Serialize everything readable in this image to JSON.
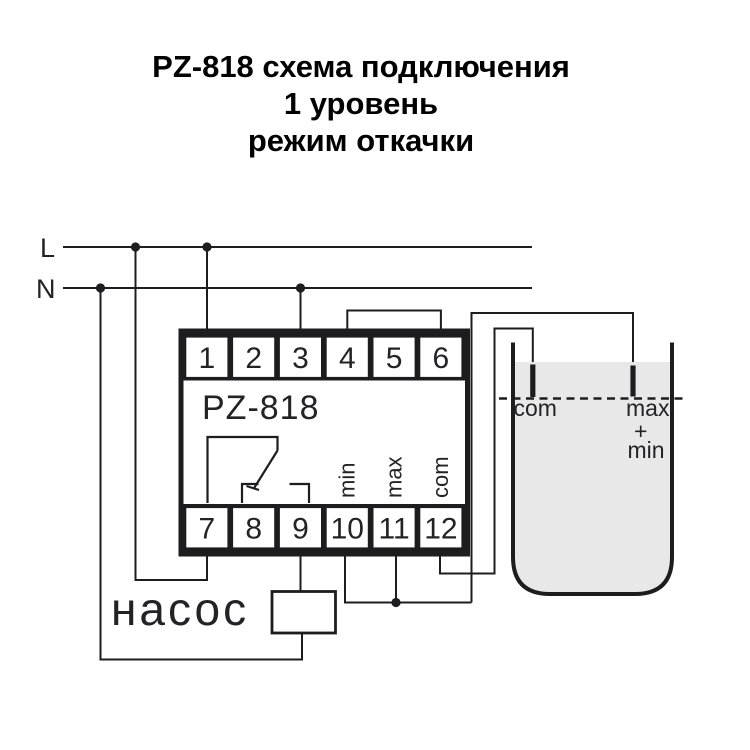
{
  "title": {
    "line1": "PZ-818 схема подключения",
    "line2": "1 уровень",
    "line3": "режим откачки"
  },
  "power_lines": {
    "l_label": "L",
    "n_label": "N"
  },
  "device": {
    "model": "PZ-818",
    "terminals_top": [
      "1",
      "2",
      "3",
      "4",
      "5",
      "6"
    ],
    "terminals_bottom": [
      "7",
      "8",
      "9",
      "10",
      "11",
      "12"
    ],
    "function_labels": {
      "min": "min",
      "max": "max",
      "com": "com"
    }
  },
  "pump": {
    "label": "насос"
  },
  "tank": {
    "electrode_com_label": "com",
    "electrode_max_label": "max",
    "electrode_plus": "+",
    "electrode_min_label": "min"
  },
  "colors": {
    "ink": "#1d1d1f",
    "water": "#e8e8e9"
  }
}
